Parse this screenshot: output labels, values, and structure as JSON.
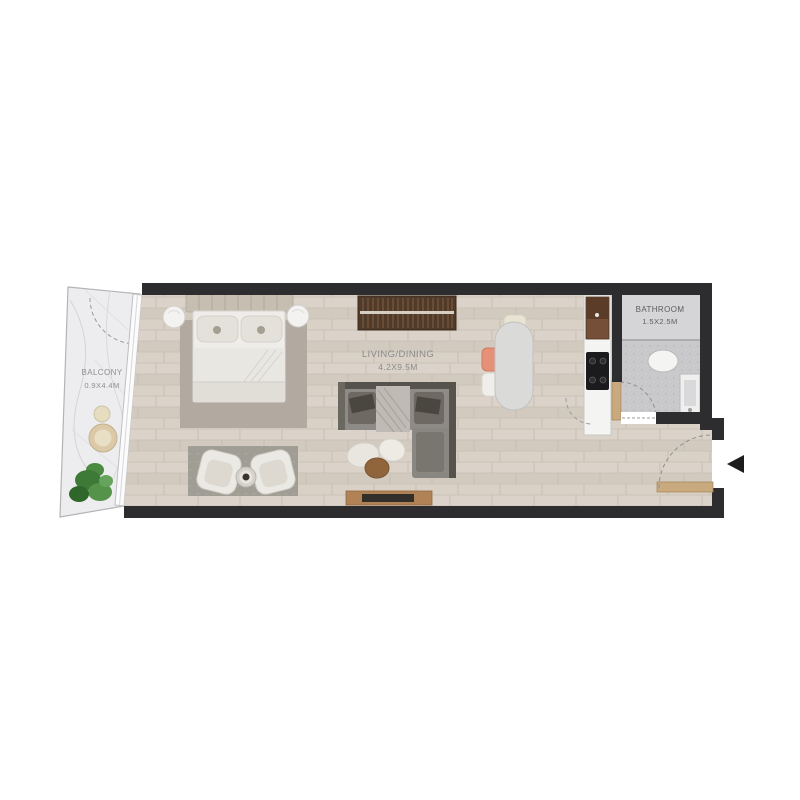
{
  "page": {
    "title": "Studio Apartment Floor Plan"
  },
  "rooms": {
    "balcony": {
      "name": "BALCONY",
      "size": "0.9X4.4M"
    },
    "living_dining": {
      "name": "LIVING/DINING",
      "size": "4.2X9.5M"
    },
    "bathroom": {
      "name": "BATHROOM",
      "size": "1.5X2.5M"
    }
  },
  "colors": {
    "wall": "#2d2d2f",
    "wood_floor": "#d7cfc5",
    "bathroom_floor": "#c9c9cb",
    "balcony_floor": "#ededef",
    "sofa": "#8e8b86",
    "wardrobe": "#503b2b",
    "tv_console": "#b18255",
    "accent_chair": "#e59077",
    "plant": "#3e7a37",
    "entry_arrow": "#1c1c1e"
  },
  "furniture": [
    "bed",
    "nightstands",
    "wardrobe",
    "l-sofa",
    "poufs",
    "tv-console",
    "dining-table",
    "dining-chairs",
    "armchairs",
    "coffee-table",
    "kitchen-counter",
    "fridge",
    "cooktop",
    "toilet",
    "sink",
    "shower",
    "balcony-table",
    "plant"
  ],
  "entrance": {
    "direction": "left"
  }
}
